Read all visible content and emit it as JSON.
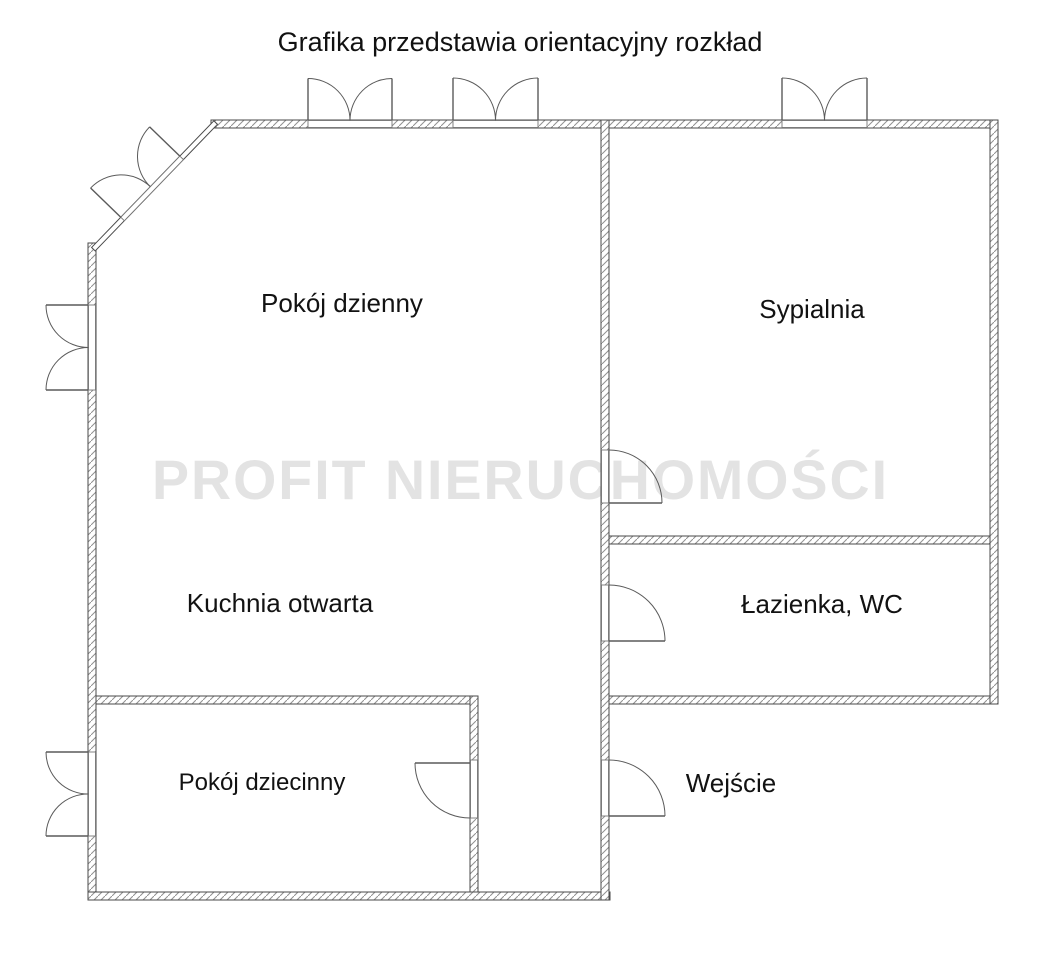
{
  "title": "Grafika przedstawia orientacyjny rozkład",
  "watermark": "PROFIT NIERUCHOMOŚCI",
  "floor_plan": {
    "type": "apartment-floor-plan",
    "rooms": [
      {
        "id": "pokoj-dzienny",
        "label": "Pokój dzienny"
      },
      {
        "id": "sypialnia",
        "label": "Sypialnia"
      },
      {
        "id": "kuchnia-otwarta",
        "label": "Kuchnia otwarta"
      },
      {
        "id": "lazienka-wc",
        "label": "Łazienka, WC"
      },
      {
        "id": "pokoj-dziecinny",
        "label": "Pokój dziecinny"
      }
    ],
    "entrance_label": "Wejście",
    "features": {
      "windows": 6,
      "doors": 4
    },
    "colors": {
      "background": "#ffffff",
      "wall_outline": "#4a4a4a",
      "hatch": "#909090",
      "label_text": "#121212",
      "watermark": "#e3e3e3"
    }
  }
}
